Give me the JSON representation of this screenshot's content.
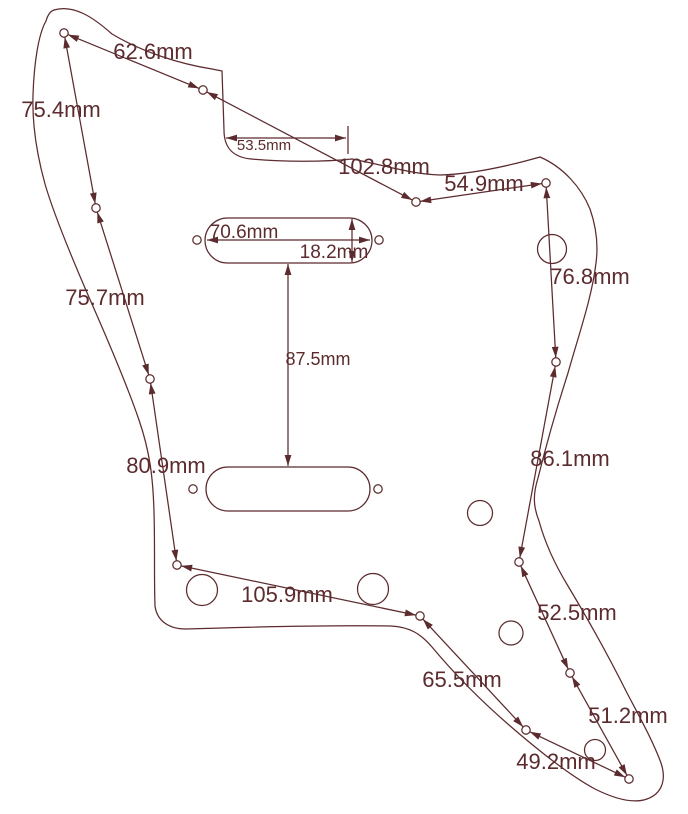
{
  "diagram": {
    "description": "Guitar pickguard technical drawing with dimension annotations",
    "unit": "mm",
    "ink_color": "#5c2b2e",
    "background_color": "#ffffff",
    "canvas": {
      "width": 688,
      "height": 814
    },
    "screw_hole_radius": 4.2,
    "measurements": [
      "62.6mm",
      "75.4mm",
      "53.5mm",
      "102.8mm",
      "54.9mm",
      "70.6mm",
      "18.2mm",
      "76.8mm",
      "75.7mm",
      "87.5mm",
      "80.9mm",
      "86.1mm",
      "105.9mm",
      "52.5mm",
      "65.5mm",
      "51.2mm",
      "49.2mm"
    ],
    "labels": [
      {
        "text": "62.6mm",
        "x": 153,
        "y": 59,
        "size": 22
      },
      {
        "text": "75.4mm",
        "x": 61,
        "y": 117,
        "size": 22
      },
      {
        "text": "53.5mm",
        "x": 264,
        "y": 150,
        "size": 15
      },
      {
        "text": "102.8mm",
        "x": 384,
        "y": 174,
        "size": 22
      },
      {
        "text": "54.9mm",
        "x": 484,
        "y": 191,
        "size": 22
      },
      {
        "text": "70.6mm",
        "x": 244,
        "y": 238,
        "size": 19
      },
      {
        "text": "18.2mm",
        "x": 334,
        "y": 258,
        "size": 19
      },
      {
        "text": "76.8mm",
        "x": 590,
        "y": 284,
        "size": 22
      },
      {
        "text": "75.7mm",
        "x": 105,
        "y": 305,
        "size": 22
      },
      {
        "text": "87.5mm",
        "x": 318,
        "y": 365,
        "size": 18
      },
      {
        "text": "80.9mm",
        "x": 166,
        "y": 473,
        "size": 22
      },
      {
        "text": "86.1mm",
        "x": 570,
        "y": 466,
        "size": 22
      },
      {
        "text": "105.9mm",
        "x": 287,
        "y": 602,
        "size": 22
      },
      {
        "text": "52.5mm",
        "x": 577,
        "y": 620,
        "size": 22
      },
      {
        "text": "65.5mm",
        "x": 462,
        "y": 687,
        "size": 22
      },
      {
        "text": "51.2mm",
        "x": 628,
        "y": 723,
        "size": 22
      },
      {
        "text": "49.2mm",
        "x": 556,
        "y": 769,
        "size": 22
      }
    ],
    "outline_path": "M 54 10 C 74 4 94 18 112 34 C 142 52 180 64 212 69 L 222 71 L 224 130 C 224 146 231 157 251 159 C 284 162 324 162 352 159 C 384 165 410 174 440 175 C 473 174 512 165 540 157 C 563 167 581 187 590 209 C 597 229 598 248 596 263 C 592 297 579 334 568 373 C 557 407 546 446 538 478 C 533 494 533 506 539 521 C 545 543 554 563 568 586 C 586 616 606 651 626 691 C 639 716 653 741 661 763 C 667 781 661 794 647 799 C 633 804 615 799 595 789 C 569 775 539 751 509 725 C 479 699 452 671 432 647 C 420 633 409 627 391 626 C 328 625 249 627 186 629 C 169 629 157 621 155 606 C 154 576 155 544 154 512 C 153 478 150 452 139 420 C 127 385 107 338 88 295 C 72 258 54 215 45 184 C 37 155 32 125 33 95 C 34 65 38 35 46 21 C 48 14 51 11 54 10 Z",
    "screw_holes": [
      {
        "x": 64,
        "y": 33
      },
      {
        "x": 203,
        "y": 90
      },
      {
        "x": 416,
        "y": 202
      },
      {
        "x": 546,
        "y": 183
      },
      {
        "x": 96,
        "y": 208
      },
      {
        "x": 150,
        "y": 379
      },
      {
        "x": 177,
        "y": 565
      },
      {
        "x": 420,
        "y": 616
      },
      {
        "x": 526,
        "y": 730
      },
      {
        "x": 629,
        "y": 779
      },
      {
        "x": 570,
        "y": 673
      },
      {
        "x": 519,
        "y": 562
      },
      {
        "x": 556,
        "y": 362
      }
    ],
    "pickup_screw_holes": [
      {
        "x": 197,
        "y": 240
      },
      {
        "x": 379,
        "y": 240
      },
      {
        "x": 193,
        "y": 489
      },
      {
        "x": 378,
        "y": 489
      }
    ],
    "large_holes": [
      {
        "x": 552,
        "y": 249,
        "r": 14.5
      },
      {
        "x": 202,
        "y": 590,
        "r": 15.5
      },
      {
        "x": 373,
        "y": 589,
        "r": 15.5
      },
      {
        "x": 480,
        "y": 513,
        "r": 12.5
      },
      {
        "x": 511,
        "y": 633,
        "r": 12
      },
      {
        "x": 595,
        "y": 750,
        "r": 10.5
      }
    ],
    "pickup_cutouts": [
      {
        "x": 205,
        "y": 218,
        "w": 167,
        "h": 45,
        "r": 22.5
      },
      {
        "x": 206,
        "y": 467,
        "w": 164,
        "h": 44,
        "r": 22
      }
    ],
    "dimension_lines": [
      {
        "label": "62.6mm",
        "x1": 64,
        "y1": 33,
        "x2": 203,
        "y2": 90,
        "trim": 4.2
      },
      {
        "label": "102.8mm",
        "x1": 203,
        "y1": 90,
        "x2": 416,
        "y2": 202,
        "trim": 4.2
      },
      {
        "label": "54.9mm",
        "x1": 416,
        "y1": 202,
        "x2": 546,
        "y2": 183,
        "trim": 4.2
      },
      {
        "label": "76.8mm",
        "x1": 546,
        "y1": 183,
        "x2": 556,
        "y2": 362,
        "trim": 4.2
      },
      {
        "label": "86.1mm",
        "x1": 556,
        "y1": 362,
        "x2": 519,
        "y2": 562,
        "trim": 4.2
      },
      {
        "label": "52.5mm",
        "x1": 519,
        "y1": 562,
        "x2": 570,
        "y2": 673,
        "trim": 4.2
      },
      {
        "label": "51.2mm",
        "x1": 570,
        "y1": 673,
        "x2": 629,
        "y2": 779,
        "trim": 4.2
      },
      {
        "label": "49.2mm",
        "x1": 526,
        "y1": 730,
        "x2": 629,
        "y2": 779,
        "trim": 4.2
      },
      {
        "label": "65.5mm",
        "x1": 420,
        "y1": 616,
        "x2": 526,
        "y2": 730,
        "trim": 4.2
      },
      {
        "label": "105.9mm",
        "x1": 177,
        "y1": 565,
        "x2": 420,
        "y2": 616,
        "trim": 4.2
      },
      {
        "label": "80.9mm",
        "x1": 150,
        "y1": 379,
        "x2": 177,
        "y2": 565,
        "trim": 4.2
      },
      {
        "label": "75.7mm",
        "x1": 96,
        "y1": 208,
        "x2": 150,
        "y2": 379,
        "trim": 4.2
      },
      {
        "label": "75.4mm",
        "x1": 64,
        "y1": 33,
        "x2": 96,
        "y2": 208,
        "trim": 4.2
      },
      {
        "label": "53.5mm",
        "x1": 226,
        "y1": 138,
        "x2": 346,
        "y2": 138,
        "trim": 0
      },
      {
        "label": "70.6mm",
        "x1": 207,
        "y1": 240,
        "x2": 370,
        "y2": 240,
        "trim": 0
      },
      {
        "label": "18.2mm",
        "x1": 352,
        "y1": 219,
        "x2": 352,
        "y2": 262,
        "trim": 0
      },
      {
        "label": "87.5mm",
        "x1": 288,
        "y1": 264,
        "x2": 288,
        "y2": 466,
        "trim": 0
      }
    ],
    "extension_ticks": [
      {
        "x1": 348,
        "y1": 126,
        "x2": 348,
        "y2": 154
      }
    ]
  }
}
